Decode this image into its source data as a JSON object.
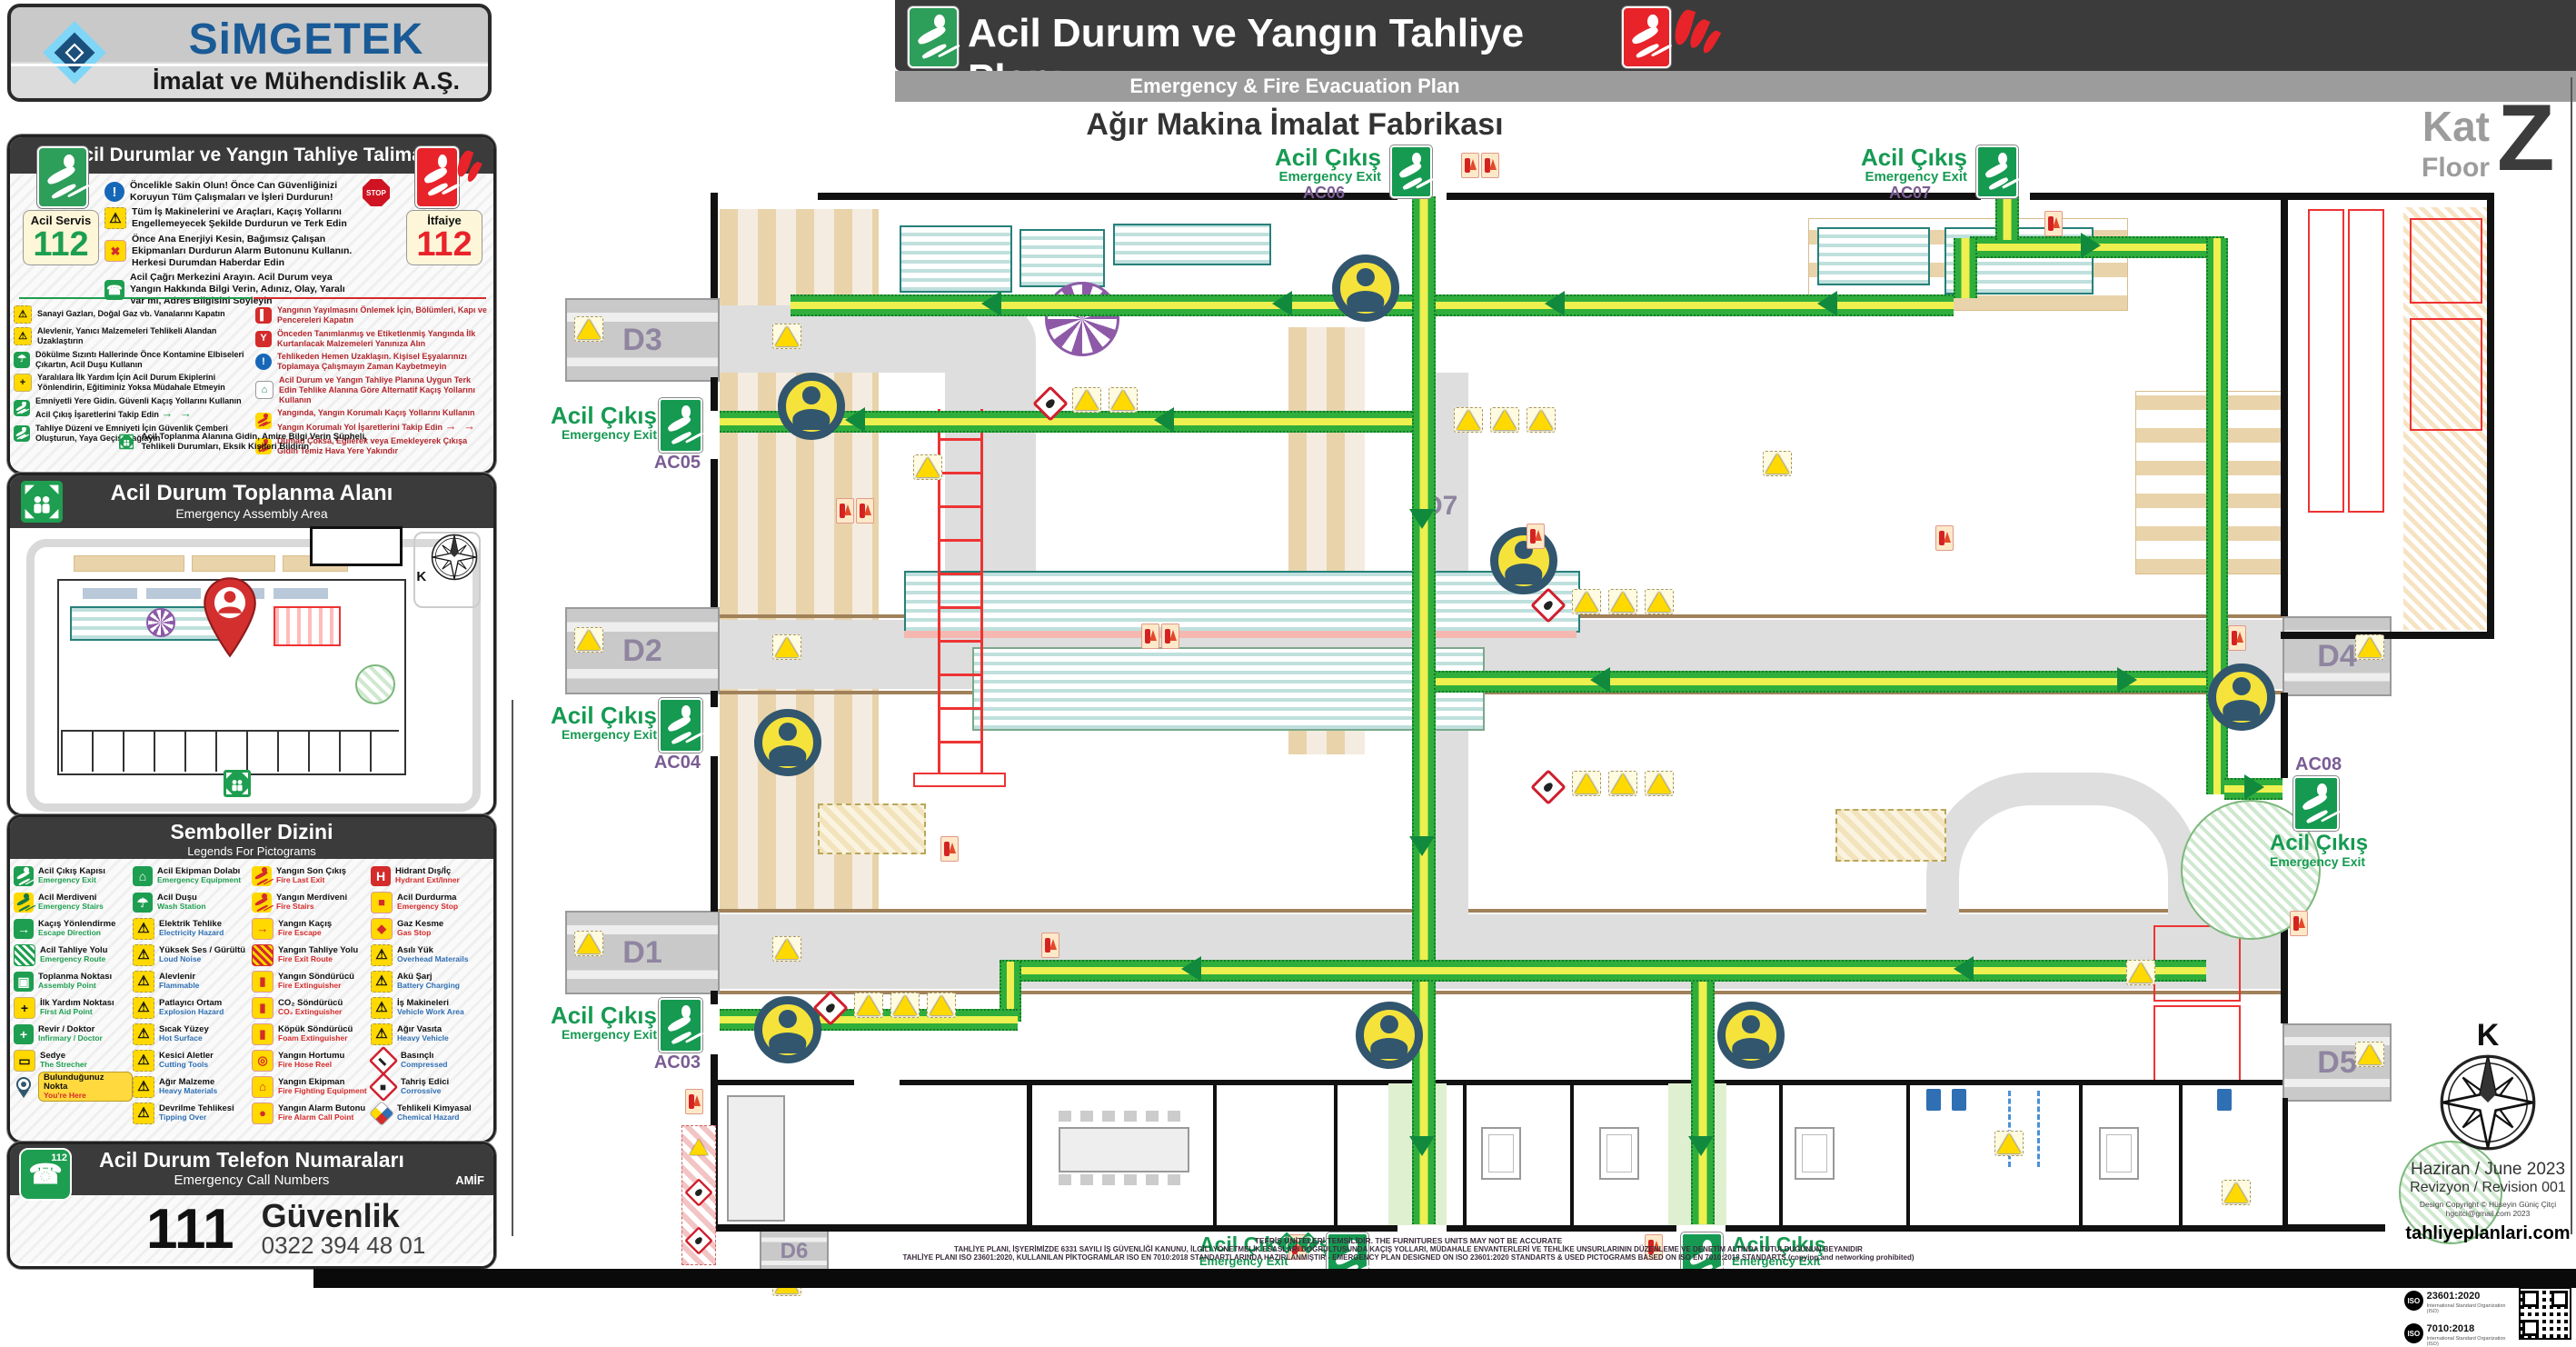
{
  "colors": {
    "exit_green": "#169a52",
    "fire_red": "#e8232a",
    "route_green": "#2fae3c",
    "accent_purple": "#7a5c93",
    "bar_dark": "#3b3b3b",
    "bar_gray": "#9c9c9c"
  },
  "brand": {
    "name": "SiMGETEK",
    "tagline": "İmalat ve Mühendislik A.Ş."
  },
  "header": {
    "title": "Acil Durum ve Yangın Tahliye Planı",
    "subtitle": "Emergency & Fire Evacuation Plan",
    "facility": "Ağır Makina İmalat Fabrikası",
    "floor_tr": "Kat",
    "floor_en": "Floor",
    "floor_value": "Z"
  },
  "instructions": {
    "title": "Acil Durumlar ve Yangın Tahliye Talimatı",
    "service_badge": {
      "label": "Acil Servis",
      "number": "112"
    },
    "fire_badge": {
      "label": "İtfaiye",
      "number": "112"
    },
    "stop_label": "STOP",
    "primary": [
      {
        "icon": "info-icon",
        "cls": "ic-info",
        "glyph": "!",
        "text": "Öncelikle Sakin Olun! Önce Can Güvenliğinizi Koruyun Tüm Çalışmaları ve İşleri Durdurun!"
      },
      {
        "icon": "vehicles-warning-icon",
        "cls": "ic-tri",
        "glyph": "⚠",
        "text": "Tüm İş Makinelerini ve Araçları, Kaçış Yollarını Engellemeyecek Şekilde Durdurun ve Terk Edin"
      },
      {
        "icon": "power-off-icon",
        "cls": "ic-fire",
        "glyph": "✖",
        "text": "Önce Ana Enerjiyi Kesin, Bağımsız Çalışan Ekipmanları Durdurun Alarm Butonunu Kullanın. Herkesi Durumdan Haberdar Edin"
      },
      {
        "icon": "emergency-call-icon",
        "cls": "ic-green",
        "glyph": "☎",
        "text": "Acil Çağrı Merkezini Arayın. Acil Durum veya Yangın Hakkında Bilgi Verin, Adınız, Olay, Yaralı Var mı, Adres Bilgisini Söyleyin"
      }
    ],
    "left": [
      {
        "icon": "gas-valves-icon",
        "cls": "ic-tri",
        "glyph": "⚠",
        "text": "Sanayi Gazları, Doğal Gaz vb. Vanalarını Kapatın"
      },
      {
        "icon": "flammable-materials-icon",
        "cls": "ic-tri",
        "glyph": "⚠",
        "text": "Alevlenir, Yanıcı Malzemeleri Tehlikeli Alandan Uzaklaştırın"
      },
      {
        "icon": "emergency-shower-icon",
        "cls": "ic-green",
        "glyph": "☂",
        "text": "Dökülme Sızıntı Hallerinde Önce Kontamine Elbiseleri Çıkartın, Acil Duşu Kullanın"
      },
      {
        "icon": "first-aid-icon",
        "cls": "ic-yellow",
        "glyph": "+",
        "text": "Yaralılara İlk Yardım İçin Acil Durum Ekiplerini Yönlendirin, Eğitiminiz Yoksa Müdahale Etmeyin"
      },
      {
        "icon": "safe-escape-icon",
        "cls": "ic-grun prun",
        "glyph": "",
        "text": "Emniyetli Yere Gidin. Güvenli Kaçış Yollarını Kullanın Acil Çıkış İşaretlerini Takip Edin",
        "suffix": "→ →",
        "sufCls": "suf-green"
      },
      {
        "icon": "evacuation-order-icon",
        "cls": "ic-grun prun",
        "glyph": "",
        "text": "Tahliye Düzeni ve Emniyeti İçin Güvenlik Çemberi Oluşturun, Yaya Geçişi Sağlayın"
      }
    ],
    "right": [
      {
        "icon": "close-doors-icon",
        "cls": "ic-redbox",
        "glyph": "▌",
        "text": "Yangının Yayılmasını Önlemek İçin, Bölümleri, Kapı ve Pencereleri Kapatın"
      },
      {
        "icon": "priority-rescue-icon",
        "cls": "ic-redbox",
        "glyph": "Y",
        "text": "Önceden Tanımlanmış ve Etiketlenmiş Yangında İlk Kurtarılacak Malzemeleri Yanınıza Alın"
      },
      {
        "icon": "leave-belongings-icon",
        "cls": "ic-info",
        "glyph": "!",
        "text": "Tehlikeden Hemen Uzaklaşın. Kişisel Eşyalarınızı Toplamaya Çalışmayın Zaman Kaybetmeyin"
      },
      {
        "icon": "follow-plan-icon",
        "cls": "ic-light",
        "glyph": "⌂",
        "text": "Acil Durum ve Yangın Tahliye Planına Uygun Terk Edin Tehlike Alanına Göre Alternatif Kaçış Yollarını Kullanın"
      },
      {
        "icon": "fire-protected-route-icon",
        "cls": "ic-frun prun",
        "glyph": "",
        "text": "Yangında, Yangın Korumalı Kaçış Yollarını Kullanın Yangın Korumalı Yol İşaretlerini Takip Edin",
        "suffix": "→ →",
        "sufCls": "suf-red"
      },
      {
        "icon": "smoke-crawl-icon",
        "cls": "ic-frun prun",
        "glyph": "",
        "text": "Duman Çoksa, Eğilerek veya Emekleyerek Çıkışa Gidin Temiz Hava Yere Yakındır"
      }
    ],
    "footer": {
      "icon": "assembly-point-icon",
      "cls": "ic-green",
      "glyph": "▣",
      "text": "Acil Toplanma Alanına Gidin, Amire Bilgi Verin Şüpheli, Tehlikeli Durumları, Eksik Kişileri Bildirin"
    }
  },
  "assembly": {
    "title": "Acil Durum Toplanma Alanı",
    "subtitle": "Emergency Assembly Area",
    "compass": "K"
  },
  "legend": {
    "title": "Semboller Dizini",
    "subtitle": "Legends For Pictograms",
    "col1": [
      {
        "tr": "Acil Çıkış Kapısı",
        "en": "Emergency Exit",
        "icon": "emergency-exit-icon",
        "cls": "ic-grun prun",
        "glyph": "",
        "enCls": "en-green"
      },
      {
        "tr": "Acil Merdiveni",
        "en": "Emergency Stairs",
        "icon": "emergency-stairs-icon",
        "cls": "ic-yrun prun",
        "glyph": "",
        "enCls": "en-green"
      },
      {
        "tr": "Kaçış Yönlendirme",
        "en": "Escape Direction",
        "icon": "escape-direction-icon",
        "cls": "ic-green",
        "glyph": "→",
        "enCls": "en-green"
      },
      {
        "tr": "Acil Tahliye Yolu",
        "en": "Emergency Route",
        "icon": "emergency-route-icon",
        "cls": "ic-ghatch",
        "glyph": "",
        "enCls": "en-green"
      },
      {
        "tr": "Toplanma Noktası",
        "en": "Assembly Point",
        "icon": "assembly-point-icon",
        "cls": "ic-green",
        "glyph": "▣",
        "enCls": "en-green"
      },
      {
        "tr": "İlk Yardım Noktası",
        "en": "First Aid Point",
        "icon": "first-aid-icon",
        "cls": "ic-yellow",
        "glyph": "+",
        "enCls": "en-green"
      },
      {
        "tr": "Revir / Doktor",
        "en": "Infirmary / Doctor",
        "icon": "infirmary-doctor-icon",
        "cls": "ic-green",
        "glyph": "+",
        "enCls": "en-green"
      },
      {
        "tr": "Sedye",
        "en": "The Strecher",
        "icon": "stretcher-icon",
        "cls": "ic-yellow",
        "glyph": "▭",
        "enCls": "en-green"
      },
      {
        "tr": "Bulunduğunuz Nokta",
        "en": "You're Here",
        "icon": "you-are-here-icon",
        "cls": "ic-pin",
        "glyph": "",
        "enCls": "en-red",
        "rowCls": "row-badge"
      }
    ],
    "col2": [
      {
        "tr": "Acil Ekipman Dolabı",
        "en": "Emergency Equipment",
        "icon": "emergency-equipment-icon",
        "cls": "ic-green",
        "glyph": "⌂",
        "enCls": "en-green"
      },
      {
        "tr": "Acil Duşu",
        "en": "Wash Station",
        "icon": "wash-station-icon",
        "cls": "ic-green",
        "glyph": "☂",
        "enCls": "en-green"
      },
      {
        "tr": "Elektrik Tehlike",
        "en": "Electricity Hazard",
        "icon": "electricity-hazard-icon",
        "cls": "ic-tri",
        "glyph": "⚠",
        "enCls": "en-blue"
      },
      {
        "tr": "Yüksek Ses / Gürültü",
        "en": "Loud Noise",
        "icon": "loud-noise-icon",
        "cls": "ic-tri",
        "glyph": "⚠",
        "enCls": "en-blue"
      },
      {
        "tr": "Alevlenir",
        "en": "Flammable",
        "icon": "flammable-icon",
        "cls": "ic-tri",
        "glyph": "⚠",
        "enCls": "en-blue"
      },
      {
        "tr": "Patlayıcı Ortam",
        "en": "Explosion Hazard",
        "icon": "explosion-hazard-icon",
        "cls": "ic-tri",
        "glyph": "⚠",
        "enCls": "en-blue"
      },
      {
        "tr": "Sıcak Yüzey",
        "en": "Hot Surface",
        "icon": "hot-surface-icon",
        "cls": "ic-tri",
        "glyph": "⚠",
        "enCls": "en-blue"
      },
      {
        "tr": "Kesici Aletler",
        "en": "Cutting Tools",
        "icon": "cutting-tools-icon",
        "cls": "ic-tri",
        "glyph": "⚠",
        "enCls": "en-blue"
      },
      {
        "tr": "Ağır Malzeme",
        "en": "Heavy Materials",
        "icon": "heavy-materials-icon",
        "cls": "ic-tri",
        "glyph": "⚠",
        "enCls": "en-blue"
      },
      {
        "tr": "Devrilme Tehlikesi",
        "en": "Tipping Over",
        "icon": "tipping-over-icon",
        "cls": "ic-tri",
        "glyph": "⚠",
        "enCls": "en-blue"
      }
    ],
    "col3": [
      {
        "tr": "Yangın Son Çıkış",
        "en": "Fire Last Exit",
        "icon": "fire-last-exit-icon",
        "cls": "ic-frun prun",
        "glyph": "",
        "enCls": "en-red"
      },
      {
        "tr": "Yangın Merdiveni",
        "en": "Fire Stairs",
        "icon": "fire-stairs-icon",
        "cls": "ic-frun prun",
        "glyph": "",
        "enCls": "en-red"
      },
      {
        "tr": "Yangın Kaçış",
        "en": "Fire Escape",
        "icon": "fire-escape-icon",
        "cls": "ic-fire",
        "glyph": "→",
        "enCls": "en-red"
      },
      {
        "tr": "Yangın Tahliye Yolu",
        "en": "Fire Exit Route",
        "icon": "fire-exit-route-icon",
        "cls": "ic-rhatch",
        "glyph": "",
        "enCls": "en-red"
      },
      {
        "tr": "Yangın Söndürücü",
        "en": "Fire Extinguisher",
        "icon": "fire-extinguisher-icon",
        "cls": "ic-fire",
        "glyph": "▮",
        "enCls": "en-red"
      },
      {
        "tr": "CO₂ Söndürücü",
        "en": "CO₂ Extinguisher",
        "icon": "co2-extinguisher-icon",
        "cls": "ic-fire",
        "glyph": "▮",
        "enCls": "en-red"
      },
      {
        "tr": "Köpük Söndürücü",
        "en": "Foam Extinguisher",
        "icon": "foam-extinguisher-icon",
        "cls": "ic-fire",
        "glyph": "▮",
        "enCls": "en-red"
      },
      {
        "tr": "Yangın Hortumu",
        "en": "Fire Hose Reel",
        "icon": "fire-hose-reel-icon",
        "cls": "ic-fire",
        "glyph": "◎",
        "enCls": "en-red"
      },
      {
        "tr": "Yangın Ekipman",
        "en": "Fire Fighting Equipment",
        "icon": "fire-fighting-equipment-icon",
        "cls": "ic-fire",
        "glyph": "⌂",
        "enCls": "en-red"
      },
      {
        "tr": "Yangın Alarm Butonu",
        "en": "Fire Alarm Call Point",
        "icon": "fire-alarm-icon",
        "cls": "ic-fire",
        "glyph": "●",
        "enCls": "en-red"
      }
    ],
    "col4": [
      {
        "tr": "Hidrant Dış/İç",
        "en": "Hydrant Ext/Inner",
        "icon": "hydrant-icon",
        "cls": "ic-redbox",
        "glyph": "H",
        "enCls": "en-red"
      },
      {
        "tr": "Acil Durdurma",
        "en": "Emergency Stop",
        "icon": "emergency-stop-icon",
        "cls": "ic-fire",
        "glyph": "■",
        "enCls": "en-red"
      },
      {
        "tr": "Gaz Kesme",
        "en": "Gas Stop",
        "icon": "gas-stop-icon",
        "cls": "ic-fire",
        "glyph": "◆",
        "enCls": "en-red"
      },
      {
        "tr": "Asılı Yük",
        "en": "Overhead Materails",
        "icon": "overhead-load-icon",
        "cls": "ic-tri",
        "glyph": "⚠",
        "enCls": "en-blue"
      },
      {
        "tr": "Akü Şarj",
        "en": "Battery Charging",
        "icon": "battery-charging-icon",
        "cls": "ic-tri",
        "glyph": "⚠",
        "enCls": "en-blue"
      },
      {
        "tr": "İş Makineleri",
        "en": "Vehicle Work Area",
        "icon": "vehicle-work-area-icon",
        "cls": "ic-tri",
        "glyph": "⚠",
        "enCls": "en-blue"
      },
      {
        "tr": "Ağır Vasıta",
        "en": "Heavy Vehicle",
        "icon": "heavy-vehicle-icon",
        "cls": "ic-tri",
        "glyph": "⚠",
        "enCls": "en-blue"
      },
      {
        "tr": "Basınçlı",
        "en": "Compressed",
        "icon": "compressed-gas-icon",
        "cls": "ic-ghs",
        "glyph": "▬",
        "enCls": "en-blue"
      },
      {
        "tr": "Tahriş Edici",
        "en": "Corrossive",
        "icon": "corrosive-icon",
        "cls": "ic-ghs",
        "glyph": "◆",
        "enCls": "en-blue"
      },
      {
        "tr": "Tehlikeli Kimyasal",
        "en": "Chemical Hazard",
        "icon": "chemical-hazard-icon",
        "cls": "ic-nfpa",
        "glyph": "",
        "enCls": "en-blue"
      }
    ]
  },
  "phones": {
    "title": "Acil Durum Telefon Numaraları",
    "subtitle": "Emergency Call Numbers",
    "org": "AMİF",
    "icon_number": "112",
    "number": "111",
    "name": "Güvenlik",
    "phone": "0322 394 48 01"
  },
  "plan": {
    "compass": "K",
    "doors": [
      "D1",
      "D2",
      "D3",
      "D4",
      "D5",
      "D6",
      "D7"
    ],
    "exits": [
      {
        "id": "AC01",
        "tr": "Acil Çıkış",
        "en": "Emergency Exit"
      },
      {
        "id": "AC02",
        "tr": "Acil Çık��ş",
        "en": "Emergency Exit"
      },
      {
        "id": "AC03",
        "tr": "Acil Çıkış",
        "en": "Emergency Exit"
      },
      {
        "id": "AC04",
        "tr": "Acil Çıkış",
        "en": "Emergency Exit"
      },
      {
        "id": "AC05",
        "tr": "Acil Çıkış",
        "en": "Emergency Exit"
      },
      {
        "id": "AC06",
        "tr": "Acil Çıkış",
        "en": "Emergency Exit"
      },
      {
        "id": "AC07",
        "tr": "Acil Çıkış",
        "en": "Emergency Exit"
      },
      {
        "id": "AC08",
        "tr": "Acil Çıkış",
        "en": "Emergency Exit"
      }
    ]
  },
  "footer": {
    "date": "Haziran / June 2023",
    "revision": "Revizyon / Revision  001",
    "copyright": "Design Copyright © Hüseyin Güniç Çitçi",
    "email": "hgcitci@gmail.com 2023",
    "website": "tahliyeplanlari.com",
    "iso_label": "ISO",
    "iso1": "23601:2020",
    "iso2": "7010:2018",
    "iso_sub": "International Standard Organization (ISO)",
    "disclaimer1": "TEFRİŞ ÜNİTELERİ TEMSİLİDİR. THE FURNITURES UNITS MAY NOT BE ACCURATE",
    "disclaimer2": "TAHLİYE PLANI, İŞYERİMİZDE 6331 SAYILI İŞ GÜVENLİĞİ KANUNU, İLGİLİ YÖNETMELİK ESASLARI DOĞRULTUSUNDA KAÇIŞ YOLLARI, MÜDAHALE ENVANTERLERİ VE TEHLİKE UNSURLARININ DÜZENLEME VE DENETİM ALTINDA TUTULDUĞUNUN BEYANIDIR",
    "disclaimer3": "TAHLİYE PLANI ISO 23601:2020, KULLANILAN PİKTOGRAMLAR ISO EN 7010:2018 STANDARTLARINDA HAZIRLANMIŞTIR - EMERGENCY PLAN DESIGNED ON ISO 23601:2020 STANDARTS & USED PICTOGRAMS BASED ON ISO EN 7010:2018 STANDARTS (copying and networking prohibited)"
  }
}
